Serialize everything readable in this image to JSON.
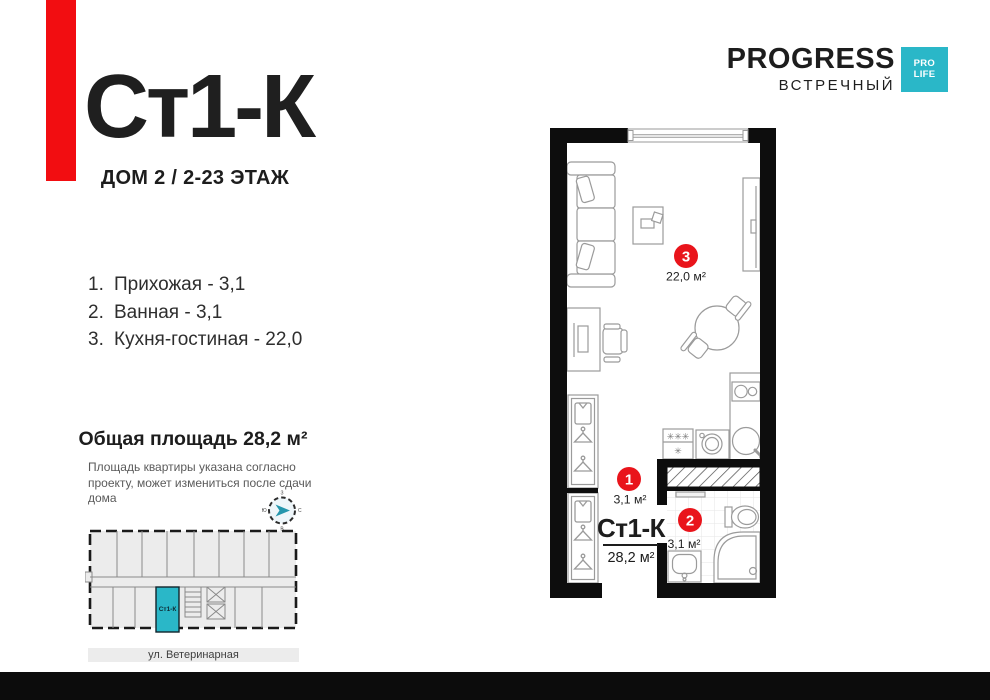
{
  "header": {
    "title": "Ст1-К",
    "subtitle": "ДОМ 2 / 2-23 ЭТАЖ"
  },
  "brand": {
    "name": "PROGRESS",
    "project": "ВСТРЕЧНЫЙ",
    "badge_line1": "PRO",
    "badge_line2": "LIFE"
  },
  "rooms": [
    {
      "num": "1.",
      "text": "Прихожая - 3,1"
    },
    {
      "num": "2.",
      "text": "Ванная - 3,1"
    },
    {
      "num": "3.",
      "text": "Кухня-гостиная - 22,0"
    }
  ],
  "total": {
    "heading": "Общая площадь 28,2 м²",
    "disclaimer": "Площадь квартиры указана согласно проекту, может измениться после сдачи дома"
  },
  "plan": {
    "unit_name": "Ст1-К",
    "unit_area": "28,2 м²",
    "markers": [
      "1",
      "2",
      "3"
    ],
    "area_hall": "3,1 м²",
    "area_bath": "3,1 м²",
    "area_kitchen": "22,0 м²",
    "hob_row1": "✳✳✳",
    "hob_row2": "✳"
  },
  "miniplan": {
    "unit_label": "Ст1-К",
    "street": "ул. Ветеринарная"
  },
  "compass": {
    "n": "С",
    "s": "Ю",
    "w": "З",
    "e": "В"
  },
  "colors": {
    "accent_red": "#f20d11",
    "marker_red": "#e9141b",
    "teal": "#2ab7c8",
    "wall_black": "#0d0d0d"
  }
}
